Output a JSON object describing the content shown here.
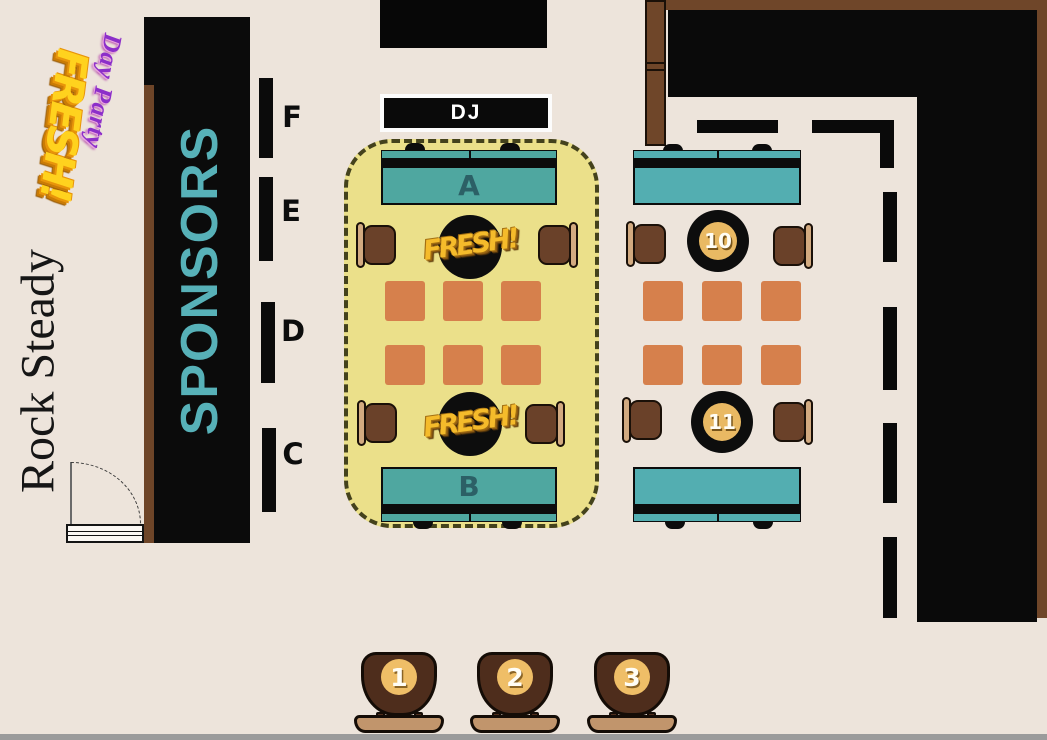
{
  "venue": {
    "name": "Rock Steady"
  },
  "event_logo": {
    "title": "FRESH!",
    "subtitle": "Day Party"
  },
  "stage": {
    "dj_label": "DJ"
  },
  "sponsors_banner": {
    "label": "SPONSORS"
  },
  "wall_sections": [
    {
      "label": "F"
    },
    {
      "label": "E"
    },
    {
      "label": "D"
    },
    {
      "label": "C"
    }
  ],
  "vip_zone": {
    "tables": [
      {
        "label": "A"
      },
      {
        "label": "B"
      }
    ],
    "table_logo_text": "FRESH!"
  },
  "numbered_tables": [
    {
      "label": "10"
    },
    {
      "label": "11"
    }
  ],
  "podiums": [
    {
      "label": "1"
    },
    {
      "label": "2"
    },
    {
      "label": "3"
    }
  ],
  "colors": {
    "background": "#EDE4DB",
    "wall_black": "#0A0A0A",
    "wood_brown": "#6F4629",
    "banner_text_teal": "#57B1B8",
    "table_teal": "#4FA7A0",
    "table_teal_right": "#53AEB1",
    "vip_yellow": "#EBE08A",
    "cushion_orange": "#D6804C",
    "chair_brown": "#6A4129",
    "chair_back_tan": "#D2AA80",
    "podium_brown": "#4E2D1C",
    "podium_base_tan": "#C1956C",
    "marker_gold": "#E9B963",
    "logo_gold": "#FFD21E",
    "logo_purple": "#8C2FC9"
  }
}
